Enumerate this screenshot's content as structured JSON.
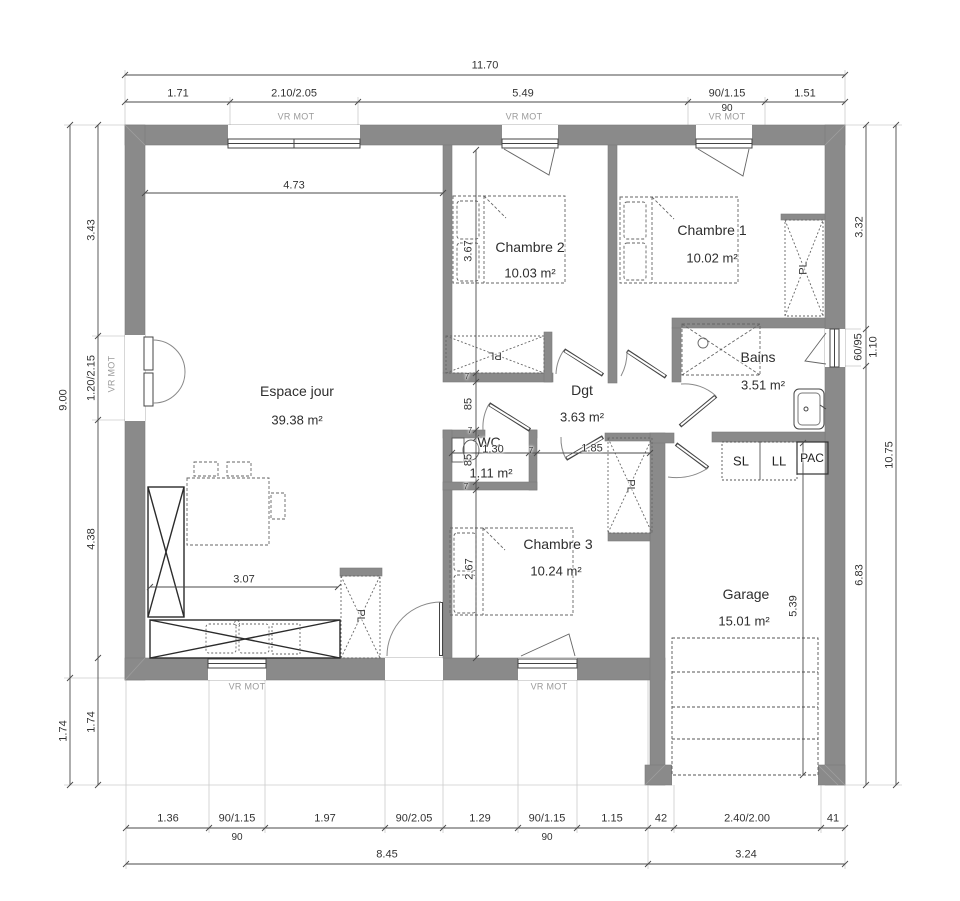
{
  "colors": {
    "wall": "#8a8a8a",
    "line": "#444444",
    "dim": "#333333",
    "muted": "#9a9a9a",
    "background": "#ffffff"
  },
  "rooms": {
    "espace_jour": {
      "name": "Espace jour",
      "area": "39.38 m²"
    },
    "chambre1": {
      "name": "Chambre 1",
      "area": "10.02 m²"
    },
    "chambre2": {
      "name": "Chambre 2",
      "area": "10.03 m²"
    },
    "chambre3": {
      "name": "Chambre 3",
      "area": "10.24 m²"
    },
    "bains": {
      "name": "Bains",
      "area": "3.51 m²"
    },
    "dgt": {
      "name": "Dgt",
      "area": "3.63 m²"
    },
    "wc": {
      "name": "WC",
      "area": "1.11 m²"
    },
    "garage": {
      "name": "Garage",
      "area": "15.01 m²"
    }
  },
  "labels": {
    "closet": "PL",
    "window_motor": "VR MOT",
    "appliances": {
      "sl": "SL",
      "ll": "LL",
      "pac": "PAC"
    }
  },
  "dims": {
    "top": {
      "total": "11.70",
      "segments": [
        "1.71",
        "2.10/2.05",
        "5.49",
        "90/1.15",
        "1.51"
      ],
      "sub": "90"
    },
    "bottom": {
      "segments": [
        "1.36",
        "90/1.15",
        "1.97",
        "90/2.05",
        "1.29",
        "90/1.15",
        "1.15",
        "42",
        "2.40/2.00",
        "41"
      ],
      "subs": [
        "90",
        "90"
      ],
      "totals": [
        "8.45",
        "3.24"
      ]
    },
    "left": {
      "outer": [
        "9.00",
        "1.74"
      ],
      "inner": [
        "3.43",
        "1.20/2.15",
        "4.38",
        "1.74"
      ]
    },
    "right": {
      "inner": [
        "3.32",
        "60/95",
        "1.10",
        "6.83"
      ],
      "outer": "10.75"
    },
    "interior": {
      "espace_top": "4.73",
      "ch2_height": "3.67",
      "passage": "85",
      "wc_height": "85",
      "wc_width": "1.30",
      "hall": "1.85",
      "ch3_height": "2.67",
      "kitchen": "3.07",
      "garage_height": "5.39",
      "partition": "7"
    }
  }
}
